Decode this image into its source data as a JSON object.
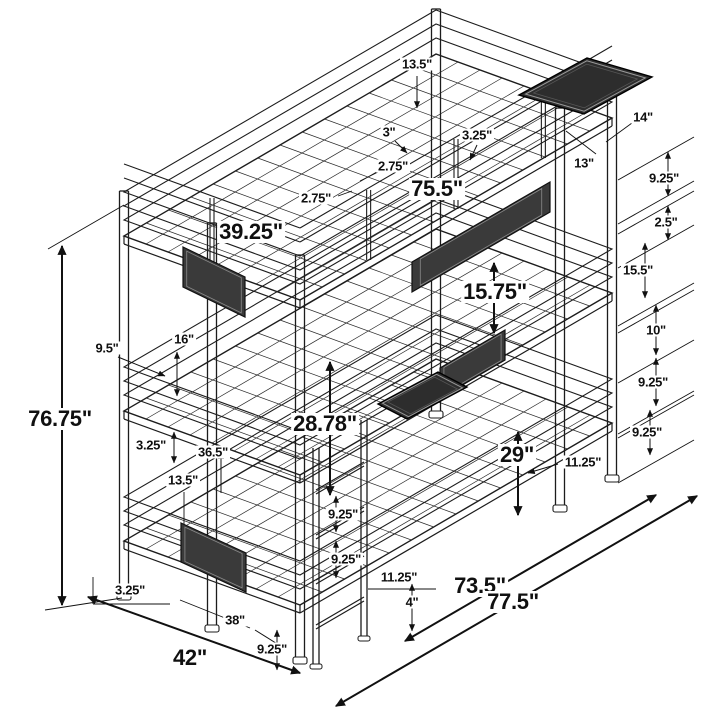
{
  "diagram": {
    "subject": "Triple twin bunk bed isometric dimension drawing",
    "unit": "inches",
    "colors": {
      "background": "#ffffff",
      "line": "#1c1c1c",
      "dimension_line": "#111111",
      "mesh_panel": "#3a3a3a",
      "tray": "#2d2d2d",
      "label_text": "#101010",
      "label_background": "#ffffff"
    },
    "overall": {
      "height": "76.75\"",
      "length": "77.5\"",
      "depth": "42\""
    },
    "labels": [
      {
        "text": "13.5\"",
        "x": 417,
        "y": 64,
        "size": "sm"
      },
      {
        "text": "3\"",
        "x": 389,
        "y": 132,
        "size": "sm"
      },
      {
        "text": "3.25\"",
        "x": 477,
        "y": 135,
        "size": "sm"
      },
      {
        "text": "2.75\"",
        "x": 393,
        "y": 166,
        "size": "sm"
      },
      {
        "text": "75.5\"",
        "x": 437,
        "y": 189,
        "size": "lg"
      },
      {
        "text": "2.75\"",
        "x": 316,
        "y": 198,
        "size": "sm"
      },
      {
        "text": "39.25\"",
        "x": 251,
        "y": 232,
        "size": "lg"
      },
      {
        "text": "13\"",
        "x": 584,
        "y": 163,
        "size": "sm"
      },
      {
        "text": "14\"",
        "x": 643,
        "y": 117,
        "size": "sm"
      },
      {
        "text": "9.25\"",
        "x": 664,
        "y": 178,
        "size": "sm"
      },
      {
        "text": "2.5\"",
        "x": 666,
        "y": 222,
        "size": "sm"
      },
      {
        "text": "15.5\"",
        "x": 638,
        "y": 270,
        "size": "sm"
      },
      {
        "text": "10\"",
        "x": 656,
        "y": 330,
        "size": "sm"
      },
      {
        "text": "15.75\"",
        "x": 495,
        "y": 292,
        "size": "lg"
      },
      {
        "text": "9.25\"",
        "x": 653,
        "y": 382,
        "size": "sm"
      },
      {
        "text": "9.25\"",
        "x": 647,
        "y": 432,
        "size": "sm"
      },
      {
        "text": "9.5\"",
        "x": 107,
        "y": 348,
        "size": "sm"
      },
      {
        "text": "16\"",
        "x": 184,
        "y": 339,
        "size": "sm"
      },
      {
        "text": "3.25\"",
        "x": 151,
        "y": 445,
        "size": "sm"
      },
      {
        "text": "36.5\"",
        "x": 213,
        "y": 452,
        "size": "sm"
      },
      {
        "text": "13.5\"",
        "x": 183,
        "y": 480,
        "size": "sm"
      },
      {
        "text": "28.78\"",
        "x": 325,
        "y": 424,
        "size": "lg"
      },
      {
        "text": "29\"",
        "x": 517,
        "y": 455,
        "size": "lg"
      },
      {
        "text": "11.25\"",
        "x": 583,
        "y": 462,
        "size": "sm"
      },
      {
        "text": "9.25\"",
        "x": 343,
        "y": 514,
        "size": "sm"
      },
      {
        "text": "9.25\"",
        "x": 346,
        "y": 559,
        "size": "sm"
      },
      {
        "text": "11.25\"",
        "x": 399,
        "y": 577,
        "size": "sm"
      },
      {
        "text": "4\"",
        "x": 412,
        "y": 602,
        "size": "sm"
      },
      {
        "text": "73.5\"",
        "x": 480,
        "y": 586,
        "size": "lg"
      },
      {
        "text": "77.5\"",
        "x": 513,
        "y": 602,
        "size": "lg"
      },
      {
        "text": "3.25\"",
        "x": 130,
        "y": 590,
        "size": "sm"
      },
      {
        "text": "38\"",
        "x": 235,
        "y": 620,
        "size": "sm"
      },
      {
        "text": "42\"",
        "x": 190,
        "y": 658,
        "size": "lg"
      },
      {
        "text": "9.25\"",
        "x": 272,
        "y": 649,
        "size": "sm"
      },
      {
        "text": "76.75\"",
        "x": 60,
        "y": 419,
        "size": "lg"
      }
    ]
  }
}
